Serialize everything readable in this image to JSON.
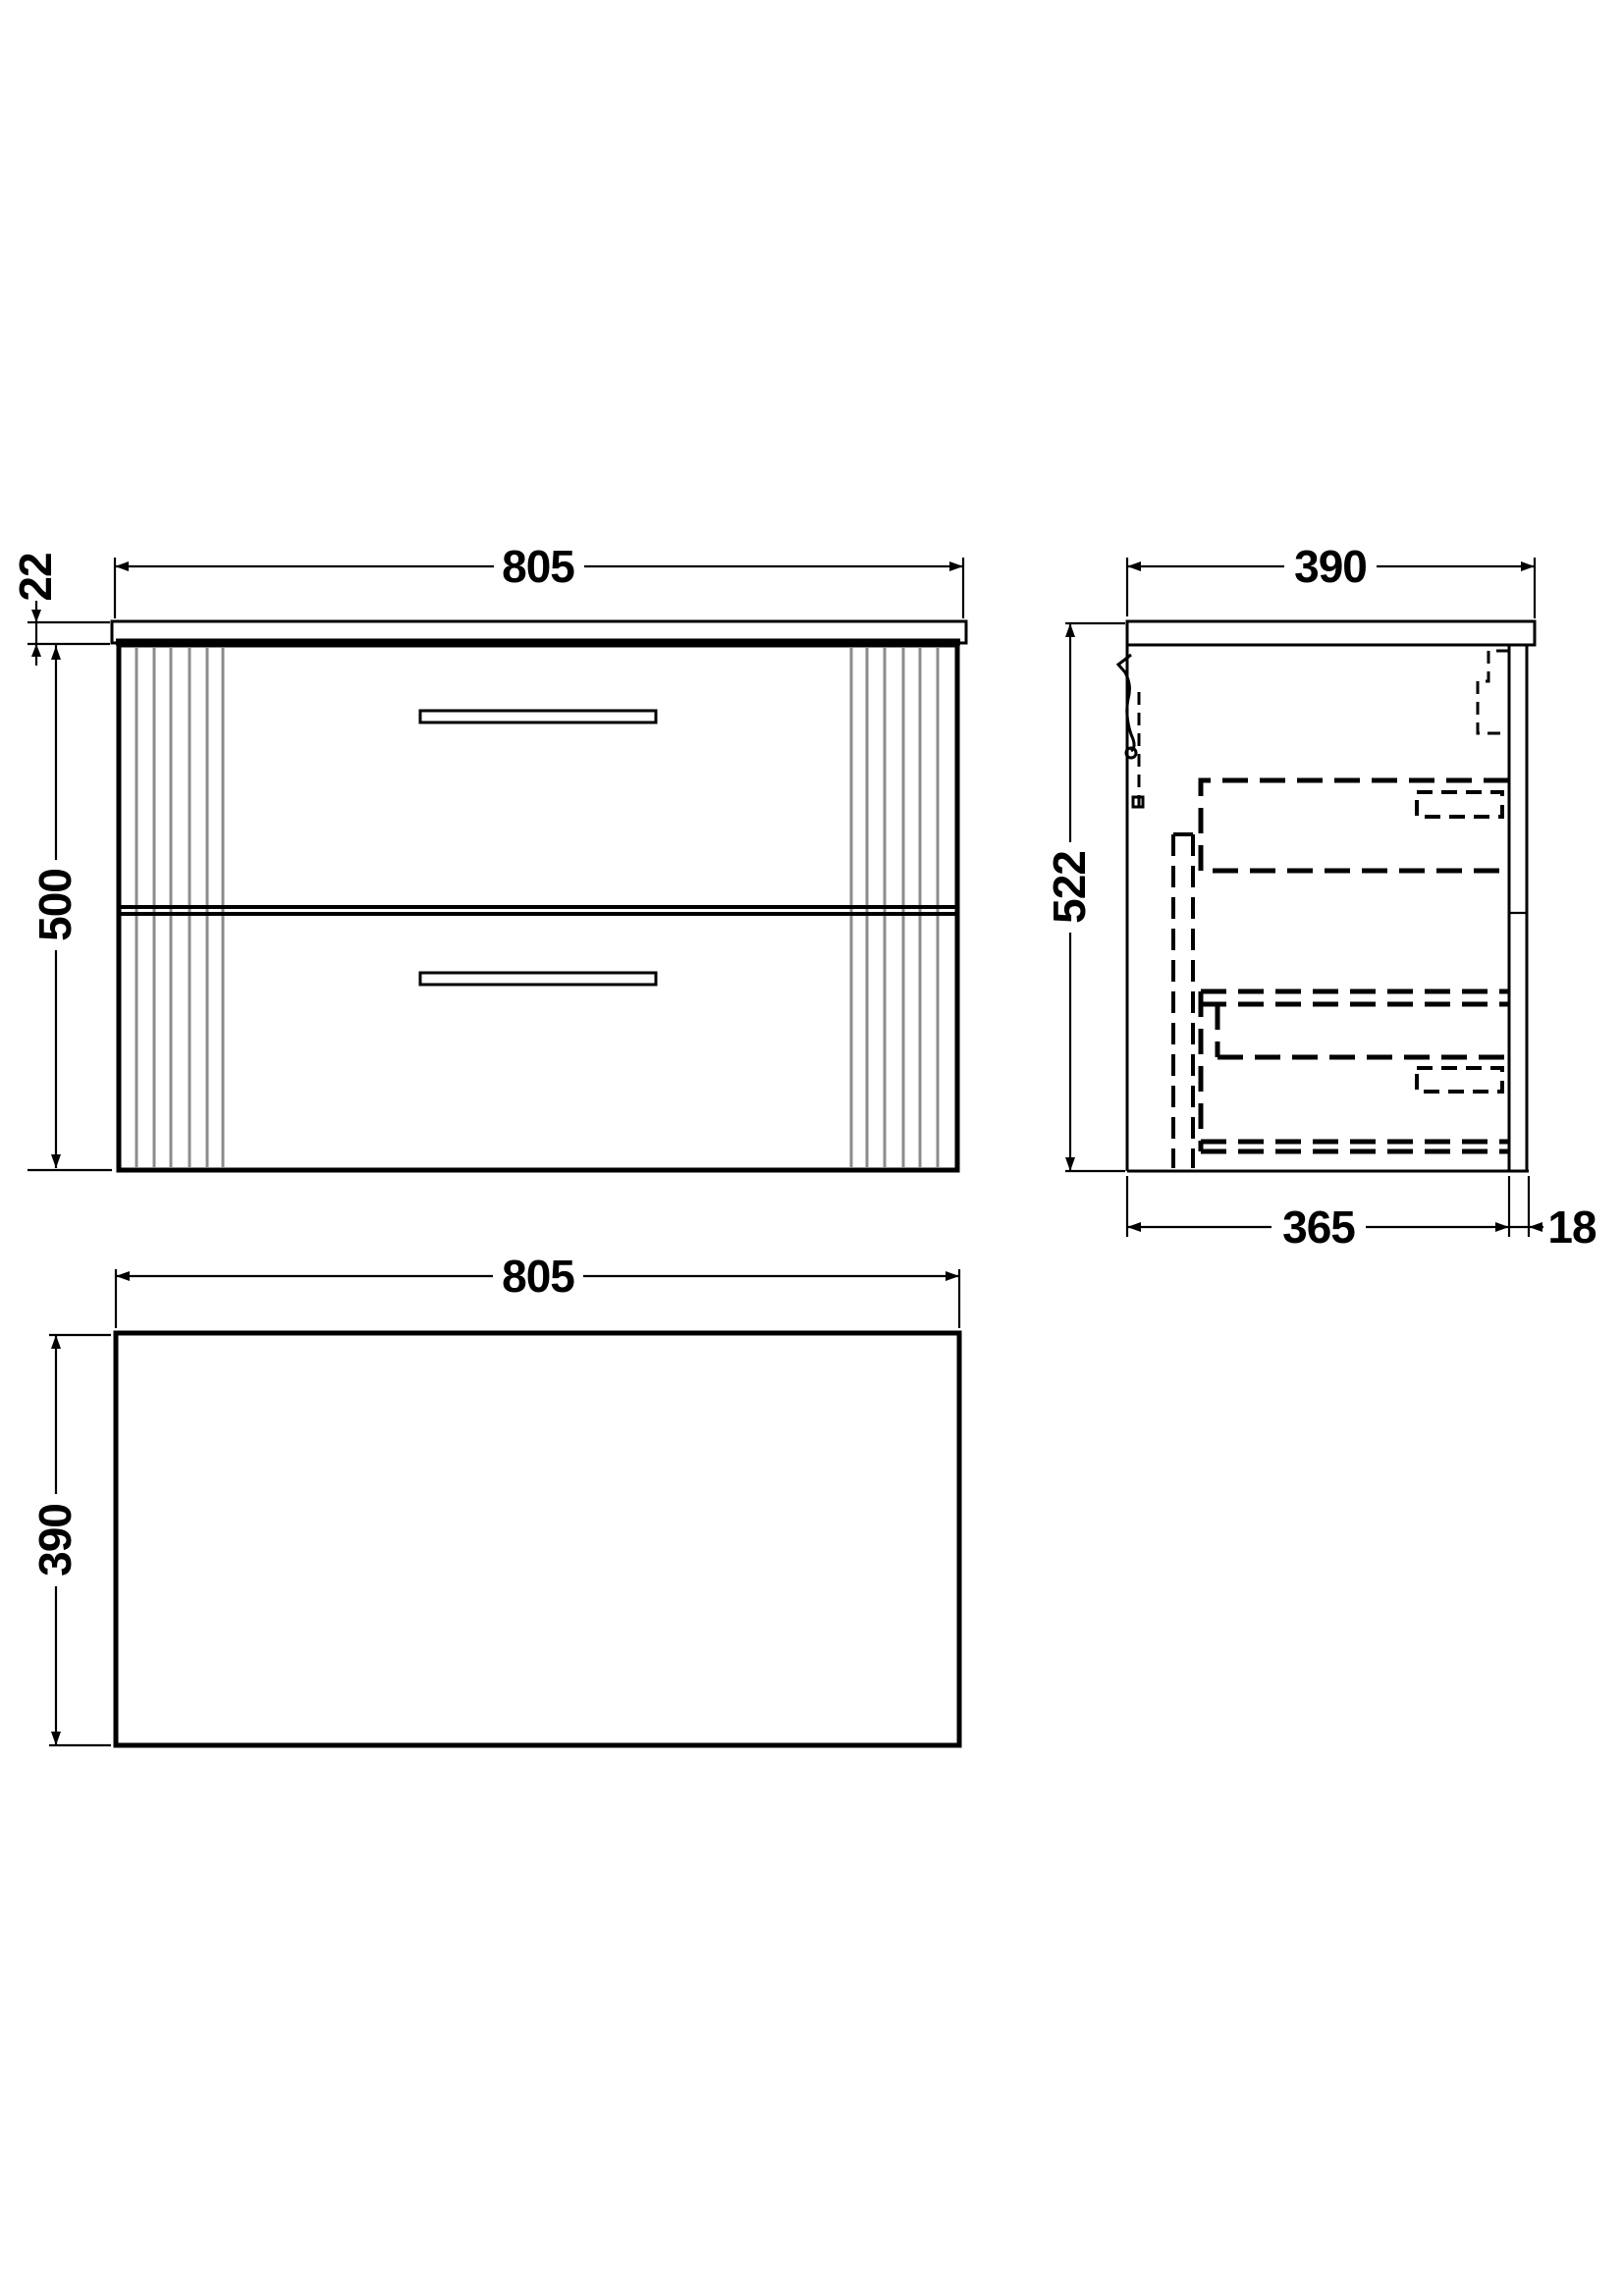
{
  "drawing": {
    "description": "Three-view technical drawing of wall-hung two-drawer vanity unit with countertop",
    "colors": {
      "line": "#000000",
      "flute_line": "#8c8c8c",
      "background": "#ffffff"
    },
    "front_view": {
      "width": "805",
      "countertop_thickness": "22",
      "height": "500"
    },
    "side_view": {
      "depth": "390",
      "height": "522",
      "carcass_depth": "365",
      "back_panel_thickness": "18"
    },
    "plan_view": {
      "width": "805",
      "depth": "390"
    }
  }
}
